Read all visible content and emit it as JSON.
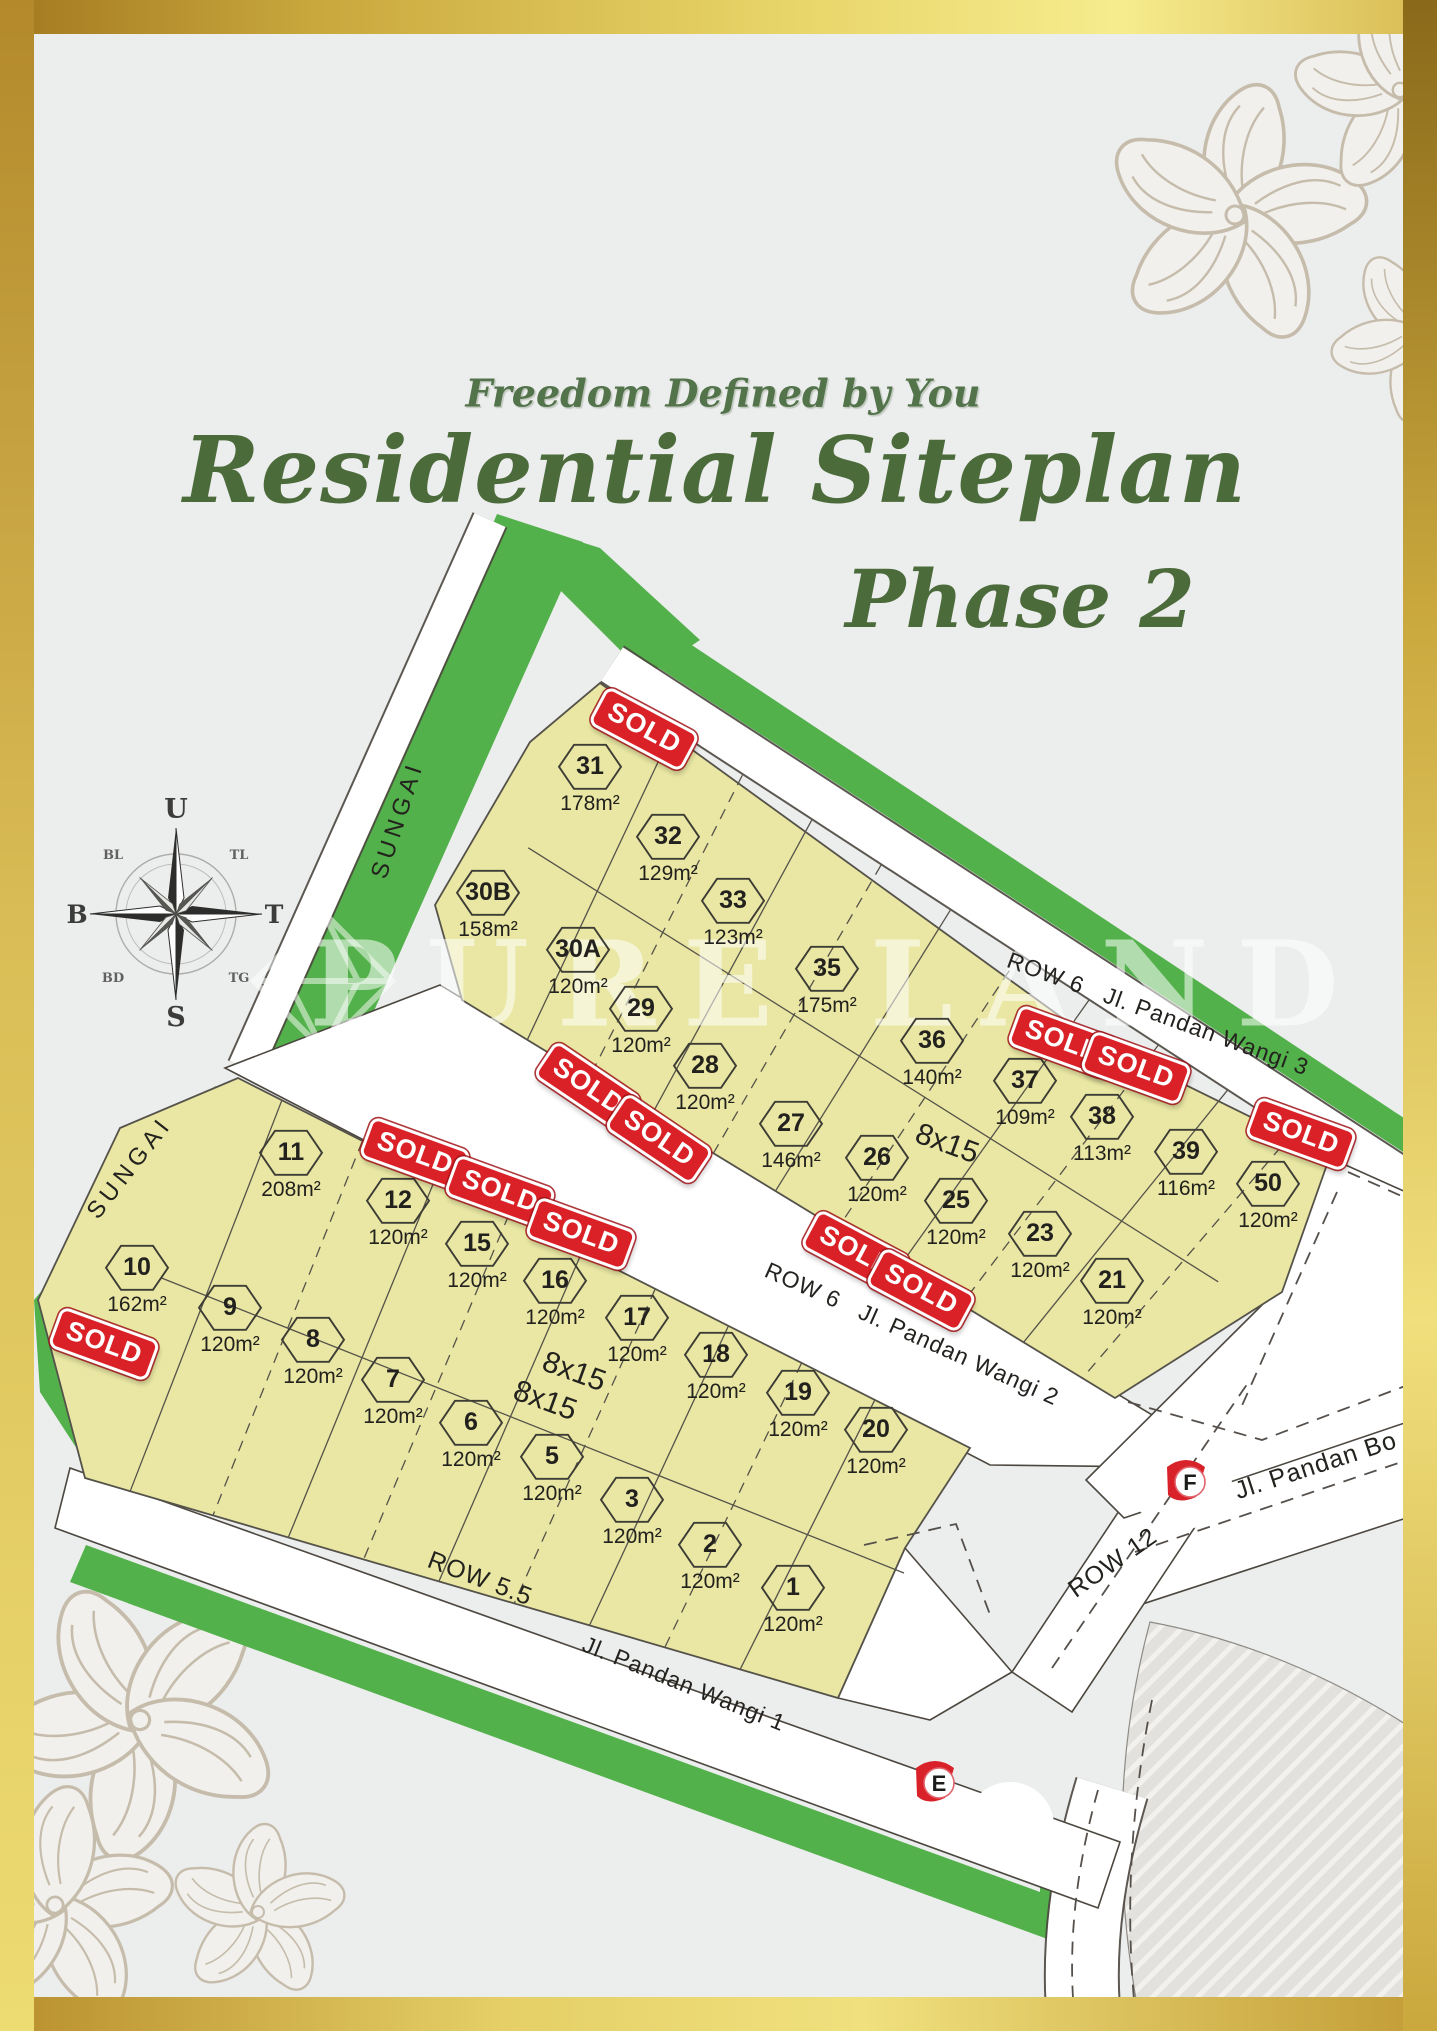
{
  "header": {
    "tagline": "Freedom Defined by You",
    "title": "Residential Siteplan",
    "subtitle": "Phase 2"
  },
  "watermark": {
    "text": "PURE LAND"
  },
  "compass": {
    "n": "U",
    "e": "T",
    "s": "S",
    "w": "B",
    "ne": "TL",
    "nw": "BL",
    "se": "TG",
    "sw": "BD"
  },
  "colors": {
    "accent_green": "#4c6b3b",
    "lot_fill": "#e9e7a3",
    "strip_green": "#53b14b",
    "sold_red": "#da2127",
    "gold": "#c9a035"
  },
  "map": {
    "sold_label": "SOLD",
    "dimension_label": "8x15",
    "road_labels": [
      {
        "text": "SUNGAI"
      },
      {
        "text": "SUNGAI"
      },
      {
        "text": "ROW 6   Jl. Pandan Wangi 3"
      },
      {
        "text": "ROW 6   Jl. Pandan Wangi 2"
      },
      {
        "text": "ROW 5.5"
      },
      {
        "text": "Jl. Pandan Wangi 1"
      },
      {
        "text": "ROW 12"
      },
      {
        "text": "Jl. Pandan Bo"
      }
    ],
    "markers": [
      {
        "label": "F"
      },
      {
        "label": "E"
      }
    ],
    "lots": [
      {
        "id": "31",
        "area": "178m²"
      },
      {
        "id": "32",
        "area": "129m²"
      },
      {
        "id": "33",
        "area": "123m²"
      },
      {
        "id": "35",
        "area": "175m²"
      },
      {
        "id": "30B",
        "area": "158m²"
      },
      {
        "id": "30A",
        "area": "120m²"
      },
      {
        "id": "29",
        "area": "120m²"
      },
      {
        "id": "28",
        "area": "120m²"
      },
      {
        "id": "27",
        "area": "146m²"
      },
      {
        "id": "26",
        "area": "120m²"
      },
      {
        "id": "25",
        "area": "120m²"
      },
      {
        "id": "36",
        "area": "140m²"
      },
      {
        "id": "37",
        "area": "109m²"
      },
      {
        "id": "38",
        "area": "113m²"
      },
      {
        "id": "39",
        "area": "116m²"
      },
      {
        "id": "50",
        "area": "120m²"
      },
      {
        "id": "23",
        "area": "120m²"
      },
      {
        "id": "21",
        "area": "120m²"
      },
      {
        "id": "11",
        "area": "208m²"
      },
      {
        "id": "12",
        "area": "120m²"
      },
      {
        "id": "15",
        "area": "120m²"
      },
      {
        "id": "16",
        "area": "120m²"
      },
      {
        "id": "17",
        "area": "120m²"
      },
      {
        "id": "18",
        "area": "120m²"
      },
      {
        "id": "19",
        "area": "120m²"
      },
      {
        "id": "20",
        "area": "120m²"
      },
      {
        "id": "10",
        "area": "162m²"
      },
      {
        "id": "9",
        "area": "120m²"
      },
      {
        "id": "8",
        "area": "120m²"
      },
      {
        "id": "7",
        "area": "120m²"
      },
      {
        "id": "6",
        "area": "120m²"
      },
      {
        "id": "5",
        "area": "120m²"
      },
      {
        "id": "3",
        "area": "120m²"
      },
      {
        "id": "2",
        "area": "120m²"
      },
      {
        "id": "1",
        "area": "120m²"
      }
    ]
  }
}
